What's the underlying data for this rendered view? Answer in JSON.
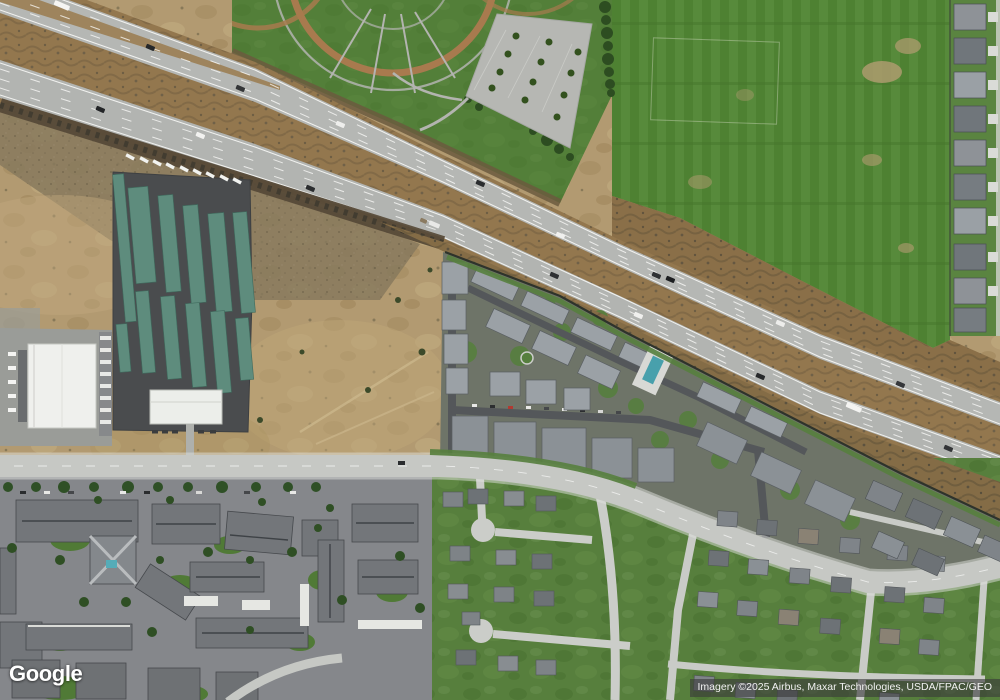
{
  "app": {
    "name": "satellite-map-view"
  },
  "watermark": {
    "logo_text": "Google"
  },
  "attribution": {
    "text": "Imagery ©2025 Airbus, Maxar Technologies, USDA/FPAC/GEO"
  },
  "palette": {
    "dirt": "#b29a71",
    "dirt_dark_zone": "#87795d",
    "park_grass": "#4f8034",
    "field_grass": "#4e8132",
    "ballfield_clay": "#a87a4e",
    "highway_asphalt": "#b5b7b4",
    "median_brush": "#9b7e53",
    "dark_brush": "#5a4e3a",
    "storage_lot": "#4a4c4e",
    "storage_roof_teal": "#5e8c7d",
    "warehouse_roof_white": "#eff0ed",
    "street": "#c9cbc7",
    "townhome_road": "#54575a",
    "roof_gray": "#7f8489",
    "lawn": "#577f3d",
    "pool_water": "#48a0ac",
    "tree": "#2d4d21"
  },
  "scene": {
    "imagery_type": "satellite",
    "features": [
      "freeway",
      "ballpark-complex",
      "sports-field",
      "parking-lot",
      "rv-storage-facility",
      "warehouse",
      "vacant-dirt-lot",
      "townhome-complex",
      "swimming-pool",
      "apartment-complex",
      "residential-grid",
      "cul-de-sacs",
      "sound-wall"
    ]
  }
}
